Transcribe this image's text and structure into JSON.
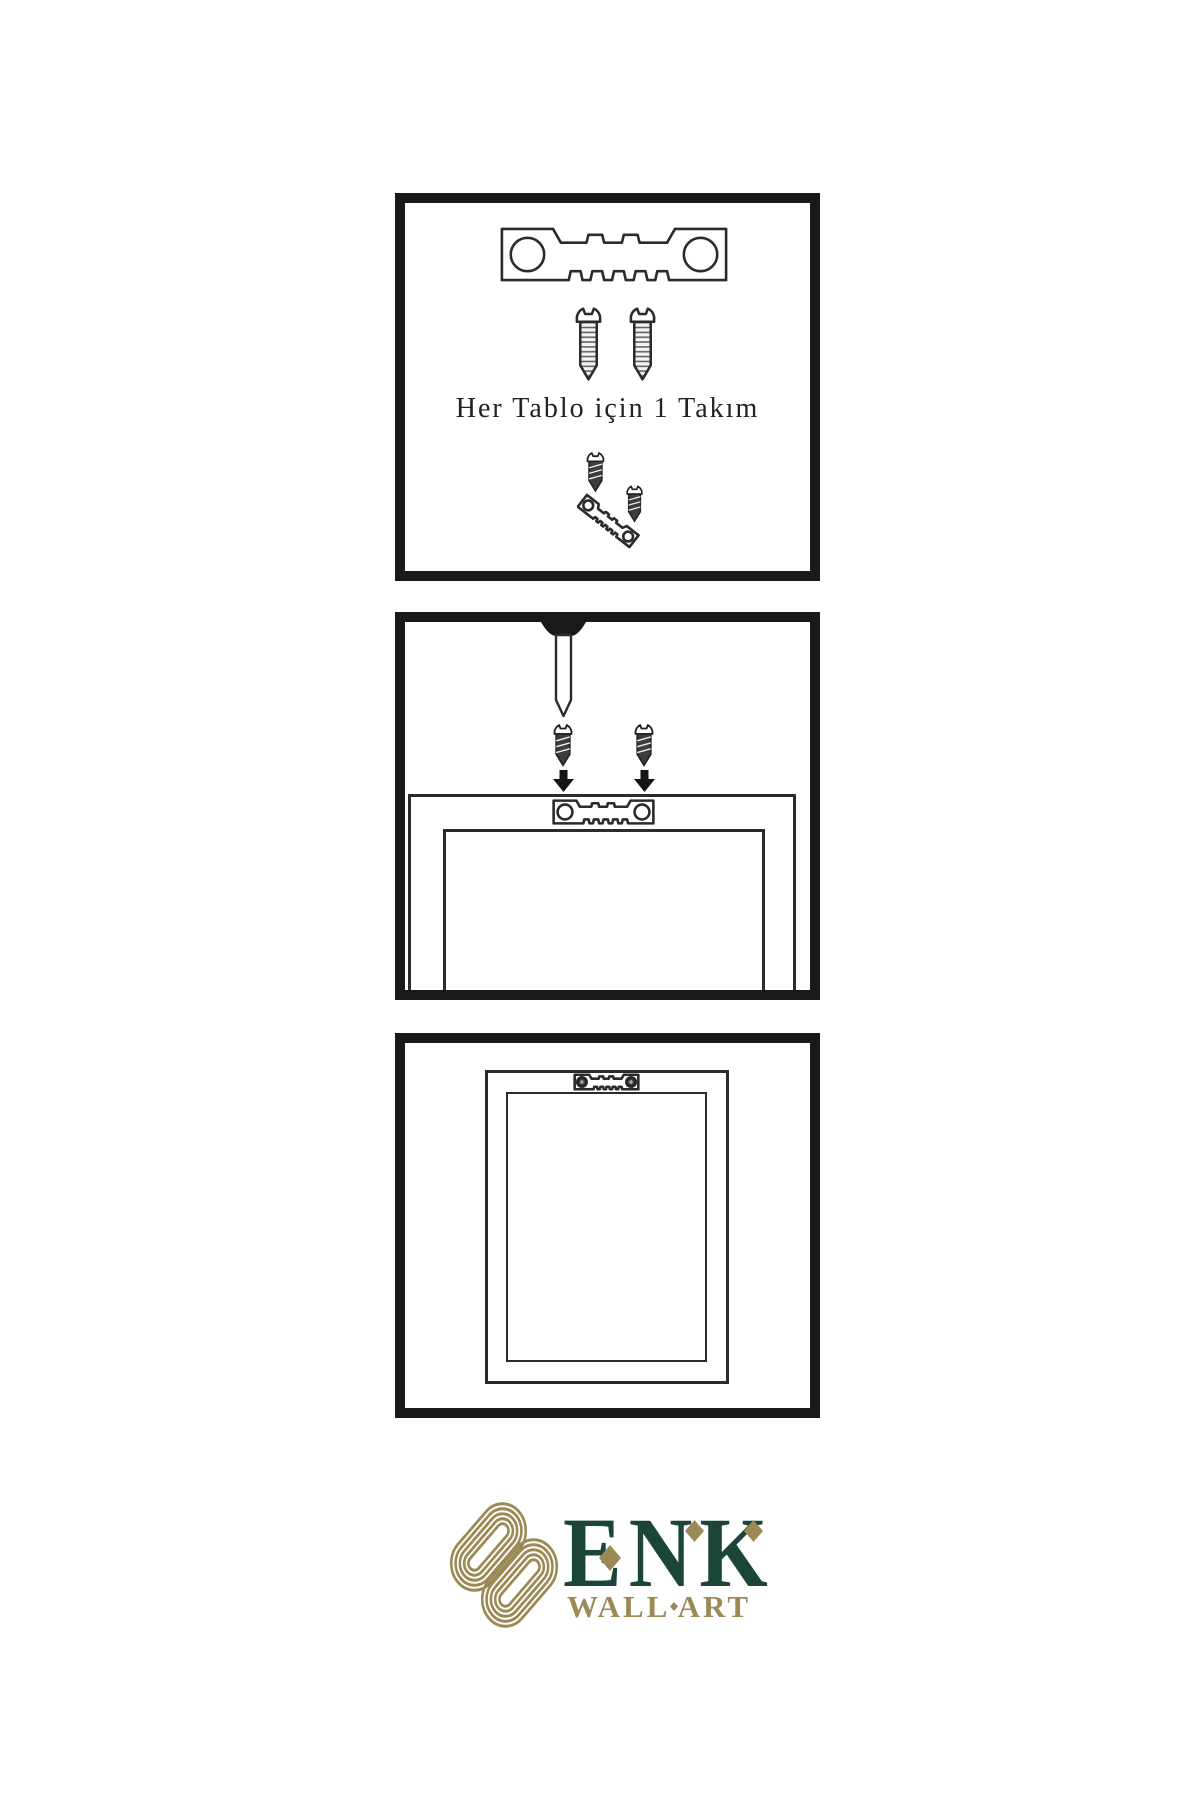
{
  "document": {
    "kind": "wall-art-hanging-instructions",
    "background": "#ffffff"
  },
  "panel_kit": {
    "caption": "Her Tablo için 1 Takım",
    "icons": [
      "sawtooth-hanger-icon",
      "screw-icon",
      "screw-icon",
      "screw-into-hanger-icon"
    ]
  },
  "panel_mount": {
    "icons": [
      "wall-nail-icon",
      "screw-icon",
      "down-arrow-icon",
      "screw-icon",
      "down-arrow-icon",
      "frame-back-icon",
      "sawtooth-hanger-icon"
    ]
  },
  "panel_hang": {
    "icons": [
      "hanging-frame-icon",
      "mounted-hanger-with-screws-icon"
    ]
  },
  "logo": {
    "brand": "ENK",
    "tagline": "WALL ART",
    "symbol": "interlaced-knot-icon"
  },
  "colors": {
    "line": "#2b2b2b",
    "panel_border": "#191919",
    "screw_dark": "#3d3d3d",
    "brand_green": "#1c4539",
    "brand_gold": "#9c8a56"
  }
}
